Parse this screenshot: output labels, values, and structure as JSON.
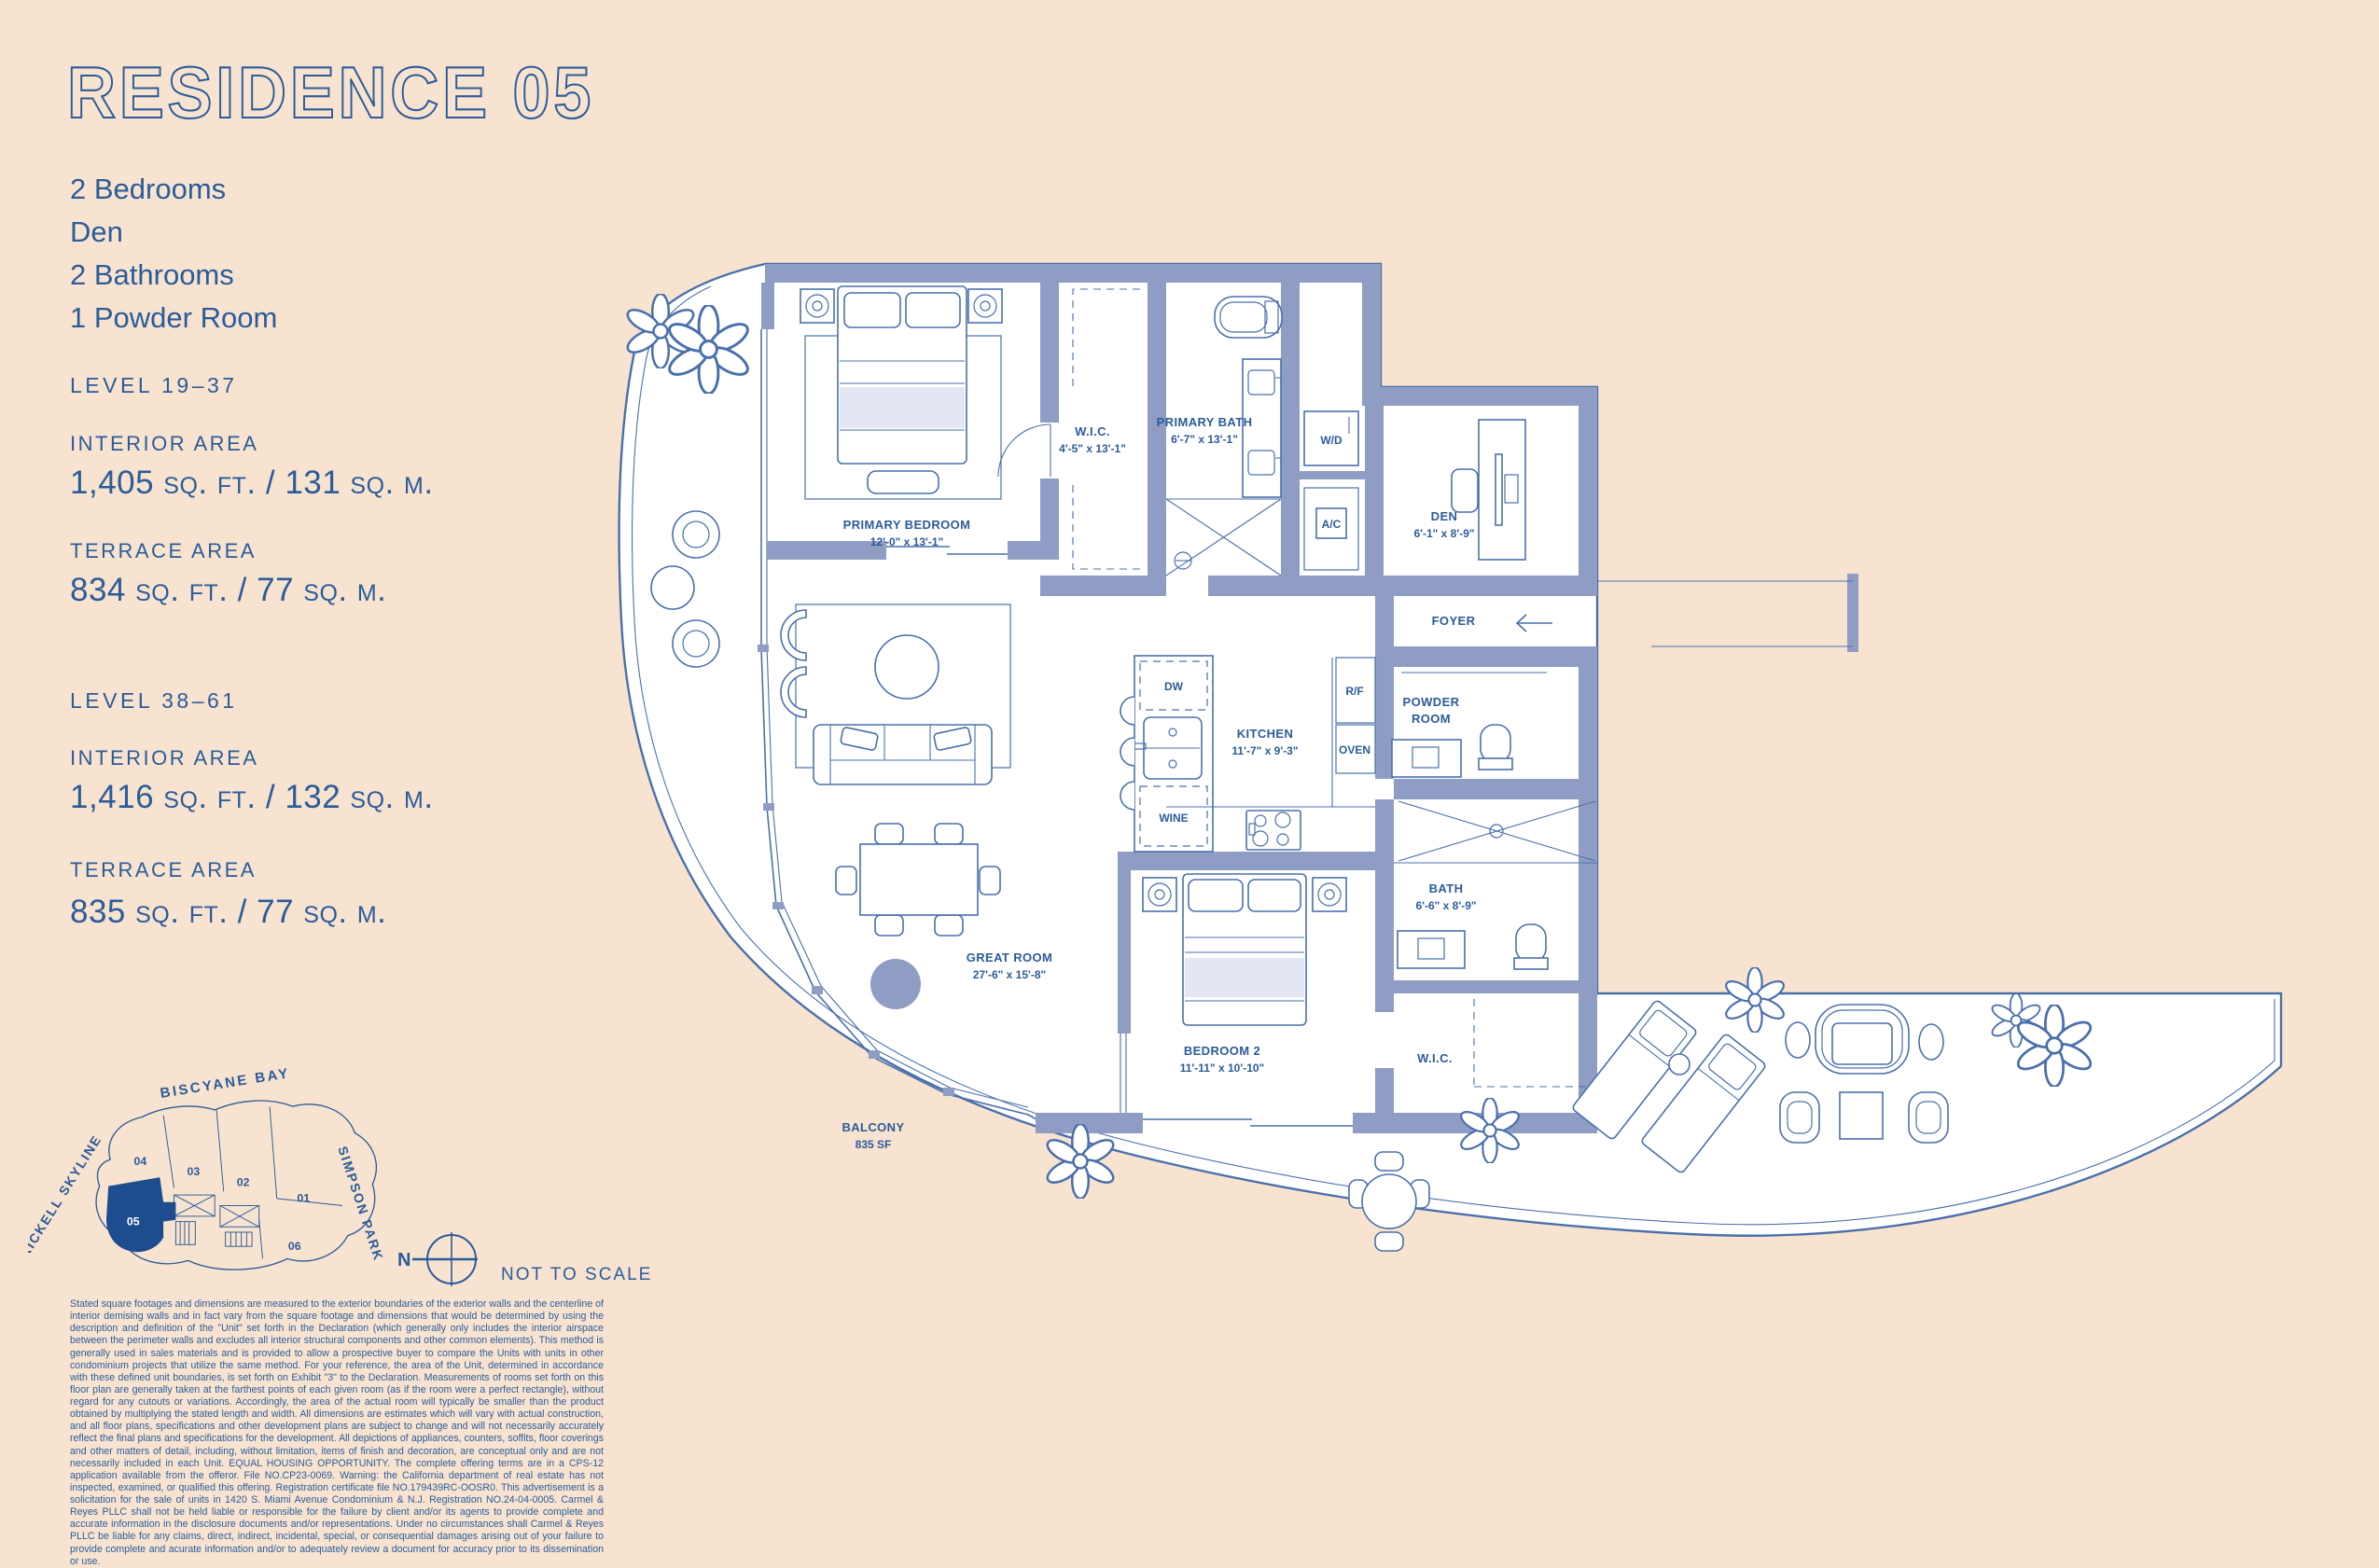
{
  "colors": {
    "background": "#f7e3d0",
    "ink": "#2b5c99",
    "wall": "#8f9dc4",
    "line": "#4a70ab",
    "highlight_unit": "#1d4c8f"
  },
  "title": "RESIDENCE 05",
  "summary": [
    "2 Bedrooms",
    "Den",
    "2 Bathrooms",
    "1 Powder Room"
  ],
  "levels": [
    {
      "name": "LEVEL 19–37",
      "interior_label": "INTERIOR AREA",
      "interior_value": "1,405 SQ. FT. / 131 SQ. M.",
      "terrace_label": "TERRACE AREA",
      "terrace_value": "834 SQ. FT. / 77 SQ. M."
    },
    {
      "name": "LEVEL 38–61",
      "interior_label": "INTERIOR AREA",
      "interior_value": "1,416 SQ. FT. / 132 SQ. M.",
      "terrace_label": "TERRACE AREA",
      "terrace_value": "835 SQ. FT. / 77 SQ. M."
    }
  ],
  "rooms": {
    "primary_bedroom": {
      "name": "PRIMARY BEDROOM",
      "dims": "12'-0\" x 13'-1\""
    },
    "wic1": {
      "name": "W.I.C.",
      "dims": "4'-5\" x 13'-1\""
    },
    "primary_bath": {
      "name": "PRIMARY BATH",
      "dims": "6'-7\" x 13'-1\""
    },
    "wd": {
      "name": "W/D"
    },
    "ac": {
      "name": "A/C"
    },
    "den": {
      "name": "DEN",
      "dims": "6'-1\" x 8'-9\""
    },
    "foyer": {
      "name": "FOYER"
    },
    "kitchen": {
      "name": "KITCHEN",
      "dims": "11'-7\" x 9'-3\""
    },
    "dw": {
      "name": "DW"
    },
    "wine": {
      "name": "WINE"
    },
    "rf": {
      "name": "R/F"
    },
    "oven": {
      "name": "OVEN"
    },
    "powder_room": {
      "line1": "POWDER",
      "line2": "ROOM"
    },
    "great_room": {
      "name": "GREAT ROOM",
      "dims": "27'-6\" x 15'-8\""
    },
    "bedroom2": {
      "name": "BEDROOM 2",
      "dims": "11'-11\" x 10'-10\""
    },
    "bath2": {
      "name": "BATH",
      "dims": "6'-6\" x 8'-9\""
    },
    "wic2": {
      "name": "W.I.C."
    },
    "balcony": {
      "name": "BALCONY",
      "dims": "835 SF"
    }
  },
  "keyplan": {
    "bay": "BISCYANE BAY",
    "skyline": "BRICKELL SKYLINE",
    "park": "SIMPSON PARK",
    "units": {
      "u01": "01",
      "u02": "02",
      "u03": "03",
      "u04": "04",
      "u05": "05",
      "u06": "06"
    },
    "highlighted": "05",
    "north": "N",
    "not_to_scale": "NOT TO SCALE"
  },
  "disclaimer": "Stated square footages and dimensions are measured to the exterior boundaries of the exterior walls and the centerline of interior demising walls and in fact vary from the square footage and dimensions that would be determined by using the description and definition of the \"Unit\" set forth in the Declaration (which generally only includes the interior airspace between the perimeter walls and excludes all interior structural components and other common elements). This method is generally used in sales materials and is provided to allow a prospective buyer to compare the Units with units in other condominium projects that utilize the same method. For your reference, the area of the Unit, determined in accordance with these defined unit boundaries, is set forth on Exhibit \"3\" to the Declaration. Measurements of rooms set forth on this floor plan are generally taken at the farthest points of each given room (as if the room were a perfect rectangle), without regard for any cutouts or variations. Accordingly, the area of the actual room will typically be smaller than the product obtained by multiplying the stated length and width. All dimensions are estimates which will vary with actual construction, and all floor plans, specifications and other development plans are subject to change and will not necessarily accurately reflect the final plans and specifications for the development. All depictions of appliances, counters, soffits, floor coverings and other matters of detail, including, without limitation, items of finish and decoration, are conceptual only and are not necessarily included in each Unit. EQUAL HOUSING OPPORTUNITY. The complete offering terms are in a CPS-12 application available from the offeror. File NO.CP23-0069. Warning: the California department of real estate has not inspected, examined, or qualified this offering. Registration certificate file NO.179439RC-OOSR0. This advertisement is a solicitation for the sale of units in 1420 S. Miami Avenue Condominium & N.J. Registration NO.24-04-0005. Carmel & Reyes PLLC shall not be held liable or responsible for the failure by client and/or its agents to provide complete and accurate information in the disclosure documents and/or representations. Under no circumstances shall Carmel & Reyes PLLC be liable for any claims, direct, indirect, incidental, special, or consequential damages arising out of your failure to provide complete and acurate information and/or to adequately review a document for accuracy prior to its dissemination or use."
}
